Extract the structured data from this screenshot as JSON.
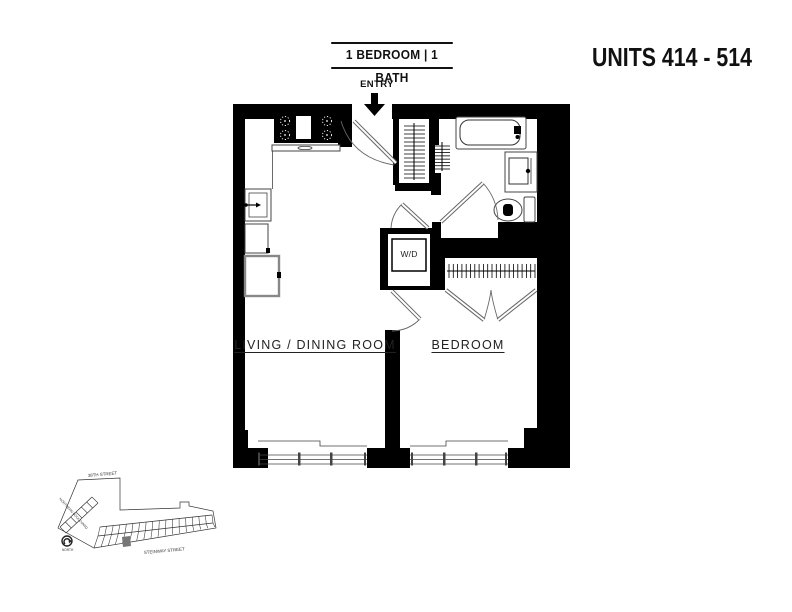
{
  "title": {
    "unit_type": "1 BEDROOM | 1 BATH",
    "units": "UNITS 414 - 514"
  },
  "floor_plan": {
    "entry_label": "ENTRY",
    "living_dining_label": "LIVING / DINING ROOM",
    "bedroom_label": "BEDROOM",
    "washer_dryer_label": "W/D"
  },
  "site_map": {
    "street_top": "38TH STREET",
    "street_bottom": "STEINWAY STREET",
    "street_diagonal": "NORTHERN BOULEVARD",
    "north_label": "NORTH"
  },
  "colors": {
    "wall": "#000000",
    "background": "#ffffff",
    "fixture_line": "#444444",
    "site_unit_fill": "#777777"
  }
}
